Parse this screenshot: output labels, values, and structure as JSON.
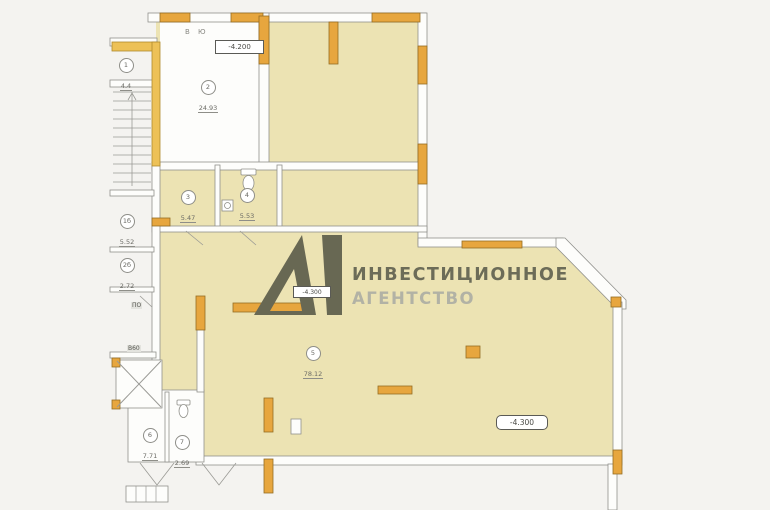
{
  "watermark": {
    "brand_line1": "ИНВЕСТИЦИОННОЕ",
    "brand_line2": "АГЕНТСТВО"
  },
  "plan": {
    "axis_label": "В Ю",
    "elevation_marks": [
      {
        "value": "-4.200"
      },
      {
        "value": "-4.300"
      },
      {
        "value": "-4.300"
      }
    ],
    "rooms": [
      {
        "number": "1",
        "area": "4.4"
      },
      {
        "number": "2",
        "area": "24.93"
      },
      {
        "number": "3",
        "area": "5.47"
      },
      {
        "number": "4",
        "area": "5.53"
      },
      {
        "number": "5",
        "area": "78.12"
      },
      {
        "number": "6",
        "area": "7.71"
      },
      {
        "number": "7",
        "area": "2.69"
      },
      {
        "number": "1б",
        "area": "5.52"
      },
      {
        "number": "2б",
        "area": "2.72"
      }
    ],
    "door_marks": [
      {
        "text": "ПО"
      },
      {
        "text": "В60"
      }
    ]
  },
  "colors": {
    "floor_fill": "#ece3b3",
    "wall_line": "#90908c",
    "lintel_orange": "#e7a63e",
    "lintel_border": "#946d24",
    "stair_frame_yellow": "#edc157",
    "watermark_dark": "#686853",
    "watermark_light": "#b2b2a5",
    "background": "#f4f3f0"
  }
}
